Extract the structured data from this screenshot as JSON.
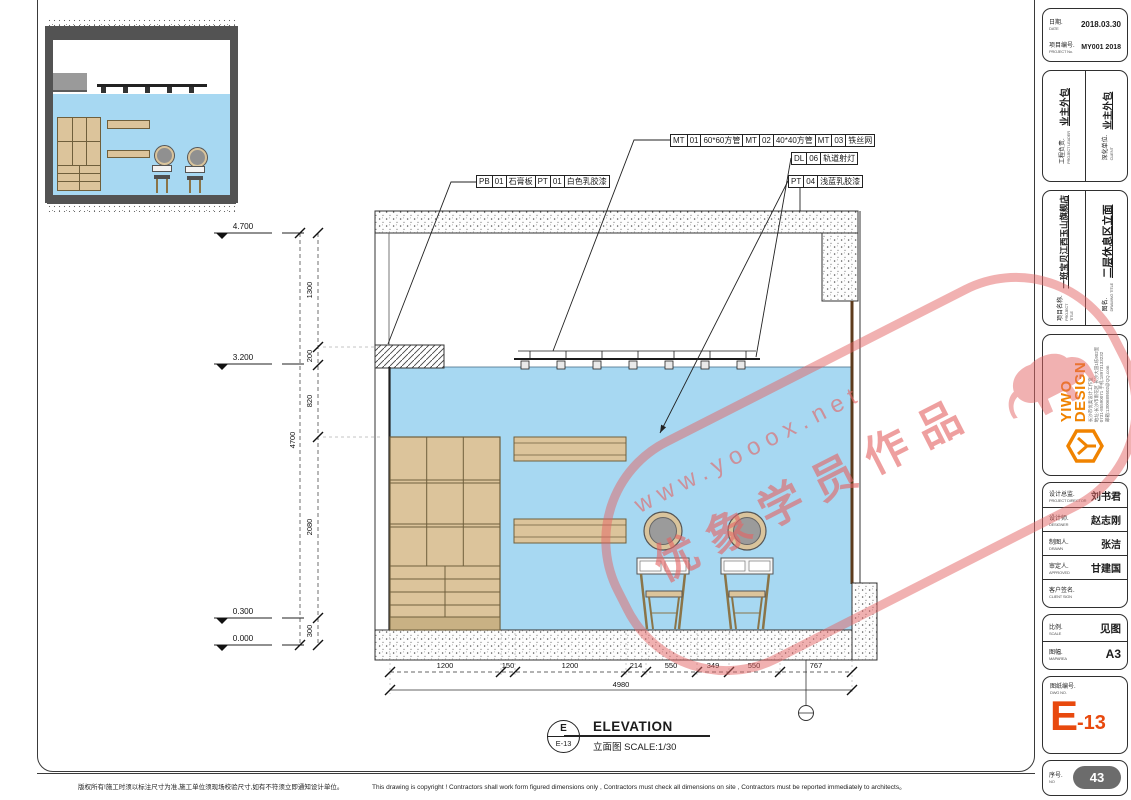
{
  "watermark": {
    "url": "www.yooox.net",
    "caption": "优象学员作品"
  },
  "callouts": {
    "pb": [
      "PB",
      "01",
      "石膏板",
      "PT",
      "01",
      "白色乳胶漆"
    ],
    "mt": [
      "MT",
      "01",
      "60*60方管",
      "MT",
      "02",
      "40*40方管",
      "MT",
      "03",
      "铁丝网"
    ],
    "dl": [
      "DL",
      "06",
      "轨道射灯"
    ],
    "pt": [
      "PT",
      "04",
      "浅蓝乳胶漆"
    ]
  },
  "levels": [
    "4.700",
    "3.200",
    "0.300",
    "0.000"
  ],
  "dims": {
    "v_segments": [
      "1300",
      "200",
      "820",
      "2080",
      "300"
    ],
    "v_total": "4700",
    "h_segments": [
      "1200",
      "150",
      "1200",
      "214",
      "550",
      "349",
      "550",
      "767"
    ],
    "h_total": "4980"
  },
  "caption": {
    "ref_letter": "E",
    "ref_sheet": "E-13",
    "title": "ELEVATION",
    "subtitle": "立面图  SCALE:1/30"
  },
  "titleblock": {
    "date": {
      "cn": "日期.",
      "en": "DATE",
      "value": "2018.03.30"
    },
    "project_no": {
      "cn": "项目编号.",
      "en": "PROJECT No.",
      "value": "MY001 2018"
    },
    "leader": {
      "cn": "工程负责.",
      "en": "PROJECT LEADER",
      "value": "业主外包"
    },
    "client": {
      "cn": "深化单位.",
      "en": "CLIENT",
      "value": "业主外包"
    },
    "project": {
      "cn": "项目名称.",
      "en": "PROJECT TITLE",
      "value": "一班宝贝江西玉山旗舰店"
    },
    "drawing": {
      "cn": "图名.",
      "en": "DRAWING TITLE",
      "value": "二层休息区立面"
    },
    "brand": {
      "line1": "YIWO",
      "line2": "DESIGN",
      "studio": "长沙市优奥设计工作室",
      "address": "地址:长沙市雨花区 长沙大道1栋902室",
      "phone": "0731-85590071 手机:18973133232",
      "email": "邮箱:1300689502@QQ.com"
    },
    "director": {
      "cn": "设计总监.",
      "en": "PROJECT DIRECTOR",
      "value": "刘书君"
    },
    "designer": {
      "cn": "设计师.",
      "en": "DESIGNER",
      "value": "赵志刚"
    },
    "drawn": {
      "cn": "制图人.",
      "en": "DRAWN",
      "value": "张洁"
    },
    "approved": {
      "cn": "审定人.",
      "en": "APPROVED",
      "value": "甘建国"
    },
    "client_sign": {
      "cn": "客户签名.",
      "en": "CLIENT SIGN",
      "value": ""
    },
    "scale": {
      "cn": "比例.",
      "en": "SCALE",
      "value": "见图"
    },
    "size": {
      "cn": "图幅.",
      "en": "MAPAREA",
      "value": "A3"
    },
    "dwg": {
      "cn": "图纸编号.",
      "en": "DWG NO.",
      "main": "E",
      "sub": "-13"
    },
    "serial": {
      "cn": "序号.",
      "en": "NO",
      "value": "43"
    }
  },
  "footer": {
    "cn": "版权所有!施工时须以标注尺寸为准,施工单位须现场校验尺寸,如有不符须立即通知设计单位。",
    "en": "This drawing is copyright ! Contractors shall work form figured dimensions only , Contractors must check all dimensions on site , Contractors must be reported immediately to architects。"
  }
}
